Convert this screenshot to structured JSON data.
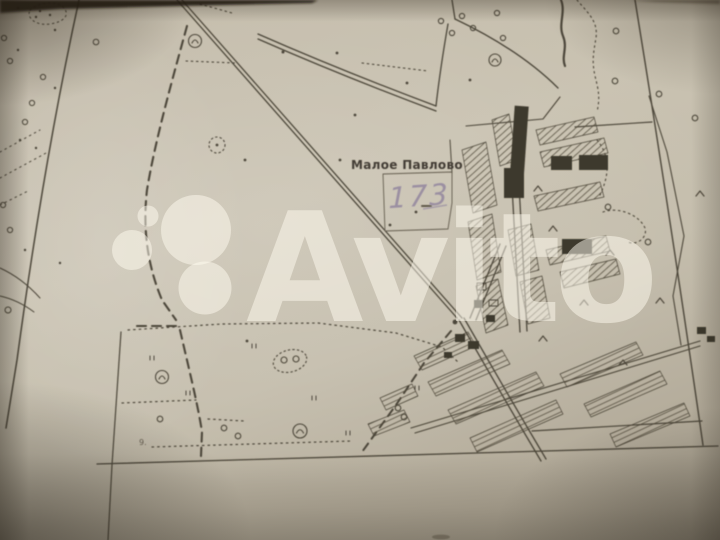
{
  "map": {
    "settlement_label": "Малое Павлово",
    "plot_number": "173",
    "edge_mark": "9.",
    "colors": {
      "paper": "#c9c2b1",
      "ink": "#433d30",
      "handwriting": "#968aa0",
      "shadow": "#a79f8e"
    }
  },
  "watermark": {
    "text": "Avito",
    "logo": "avito-four-circles-logo",
    "color": "#fffbf0",
    "opacity": "0.5"
  }
}
